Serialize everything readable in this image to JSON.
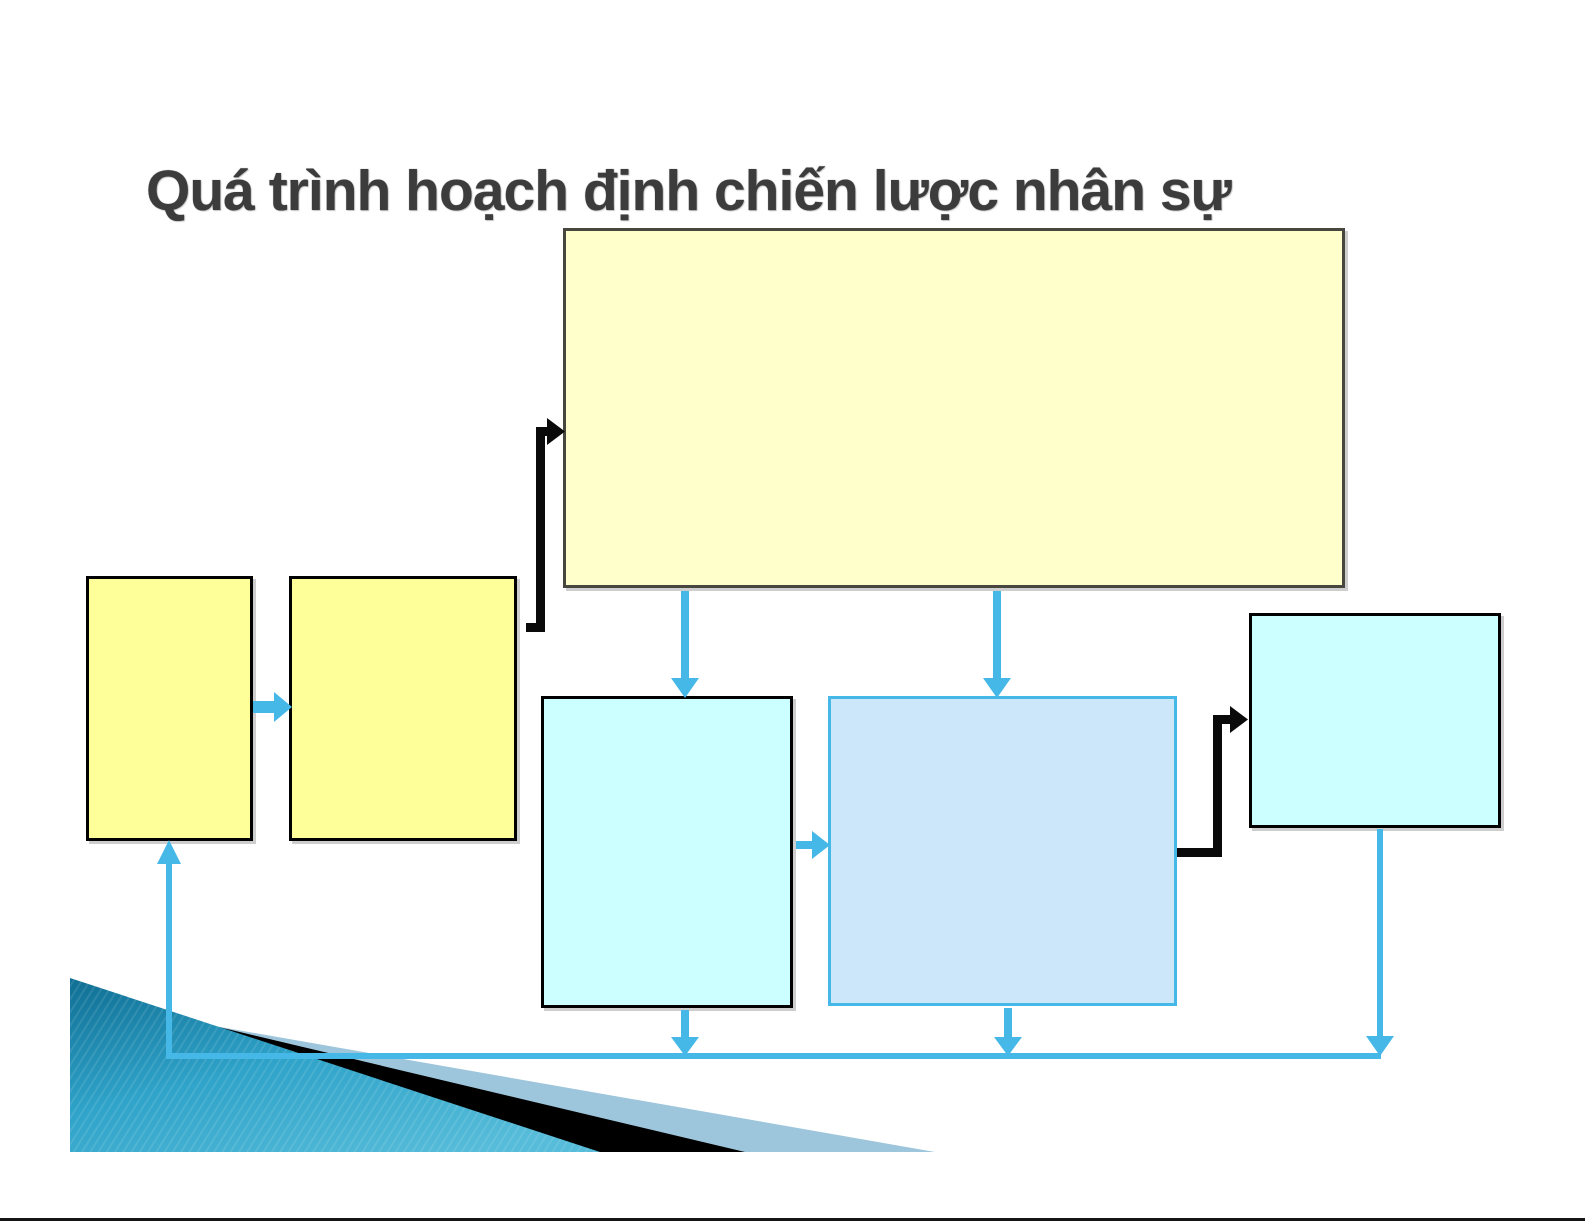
{
  "slide": {
    "title": "Quá trình hoạch định chiến lược nhân sự",
    "background": "#FFFFFF"
  },
  "diagram": {
    "type": "flowchart",
    "nodes": [
      {
        "id": "top-wide",
        "label": "",
        "fill": "#FFFFCC",
        "border": "#47473F"
      },
      {
        "id": "left-a",
        "label": "",
        "fill": "#FFFF99",
        "border": "#000000"
      },
      {
        "id": "left-b",
        "label": "",
        "fill": "#FFFF99",
        "border": "#000000"
      },
      {
        "id": "mid-cyan",
        "label": "",
        "fill": "#CCFFFF",
        "border": "#000000"
      },
      {
        "id": "mid-blue",
        "label": "",
        "fill": "#CBE7F9",
        "border": "#45B8E8"
      },
      {
        "id": "right-cyan",
        "label": "",
        "fill": "#CCFFFF",
        "border": "#000000"
      }
    ],
    "connectors": [
      {
        "id": "left-a-to-left-b",
        "style": "blue-arrow",
        "from": "left-a",
        "to": "left-b"
      },
      {
        "id": "left-b-to-top-wide",
        "style": "black-elbow",
        "from": "left-b",
        "to": "top-wide"
      },
      {
        "id": "top-wide-to-mid-cyan",
        "style": "blue-arrow",
        "from": "top-wide",
        "to": "mid-cyan"
      },
      {
        "id": "top-wide-to-mid-blue",
        "style": "blue-arrow",
        "from": "top-wide",
        "to": "mid-blue"
      },
      {
        "id": "mid-cyan-to-mid-blue",
        "style": "blue-arrow",
        "from": "mid-cyan",
        "to": "mid-blue"
      },
      {
        "id": "mid-blue-to-right-cyan",
        "style": "black-elbow",
        "from": "mid-blue",
        "to": "right-cyan"
      },
      {
        "id": "mid-cyan-to-feedback",
        "style": "blue-arrow",
        "from": "mid-cyan",
        "to": "feedback-line"
      },
      {
        "id": "mid-blue-to-feedback",
        "style": "blue-arrow",
        "from": "mid-blue",
        "to": "feedback-line"
      },
      {
        "id": "right-cyan-to-feedback",
        "style": "blue-arrow",
        "from": "right-cyan",
        "to": "feedback-line"
      },
      {
        "id": "feedback-to-left-a",
        "style": "blue-line-arrow",
        "from": "feedback-line",
        "to": "left-a"
      }
    ],
    "colors": {
      "arrow_blue": "#45B8E8",
      "connector_black": "#0A0A0A",
      "node_yellow": "#FFFF99",
      "node_pale_yellow": "#FFFFCC",
      "node_cyan": "#CCFFFF",
      "node_light_blue": "#CBE7F9",
      "node_blue_border": "#45B8E8",
      "title_gray": "#3C3C3C",
      "decor_teal_dark": "#0F6E93",
      "decor_teal_light": "#56BCD9",
      "decor_steel_blue": "#9DC5DB",
      "decor_black": "#000000",
      "bottom_rule": "#151515"
    },
    "decoration": "layered teal, black and steel-blue wedge at bottom-left"
  }
}
